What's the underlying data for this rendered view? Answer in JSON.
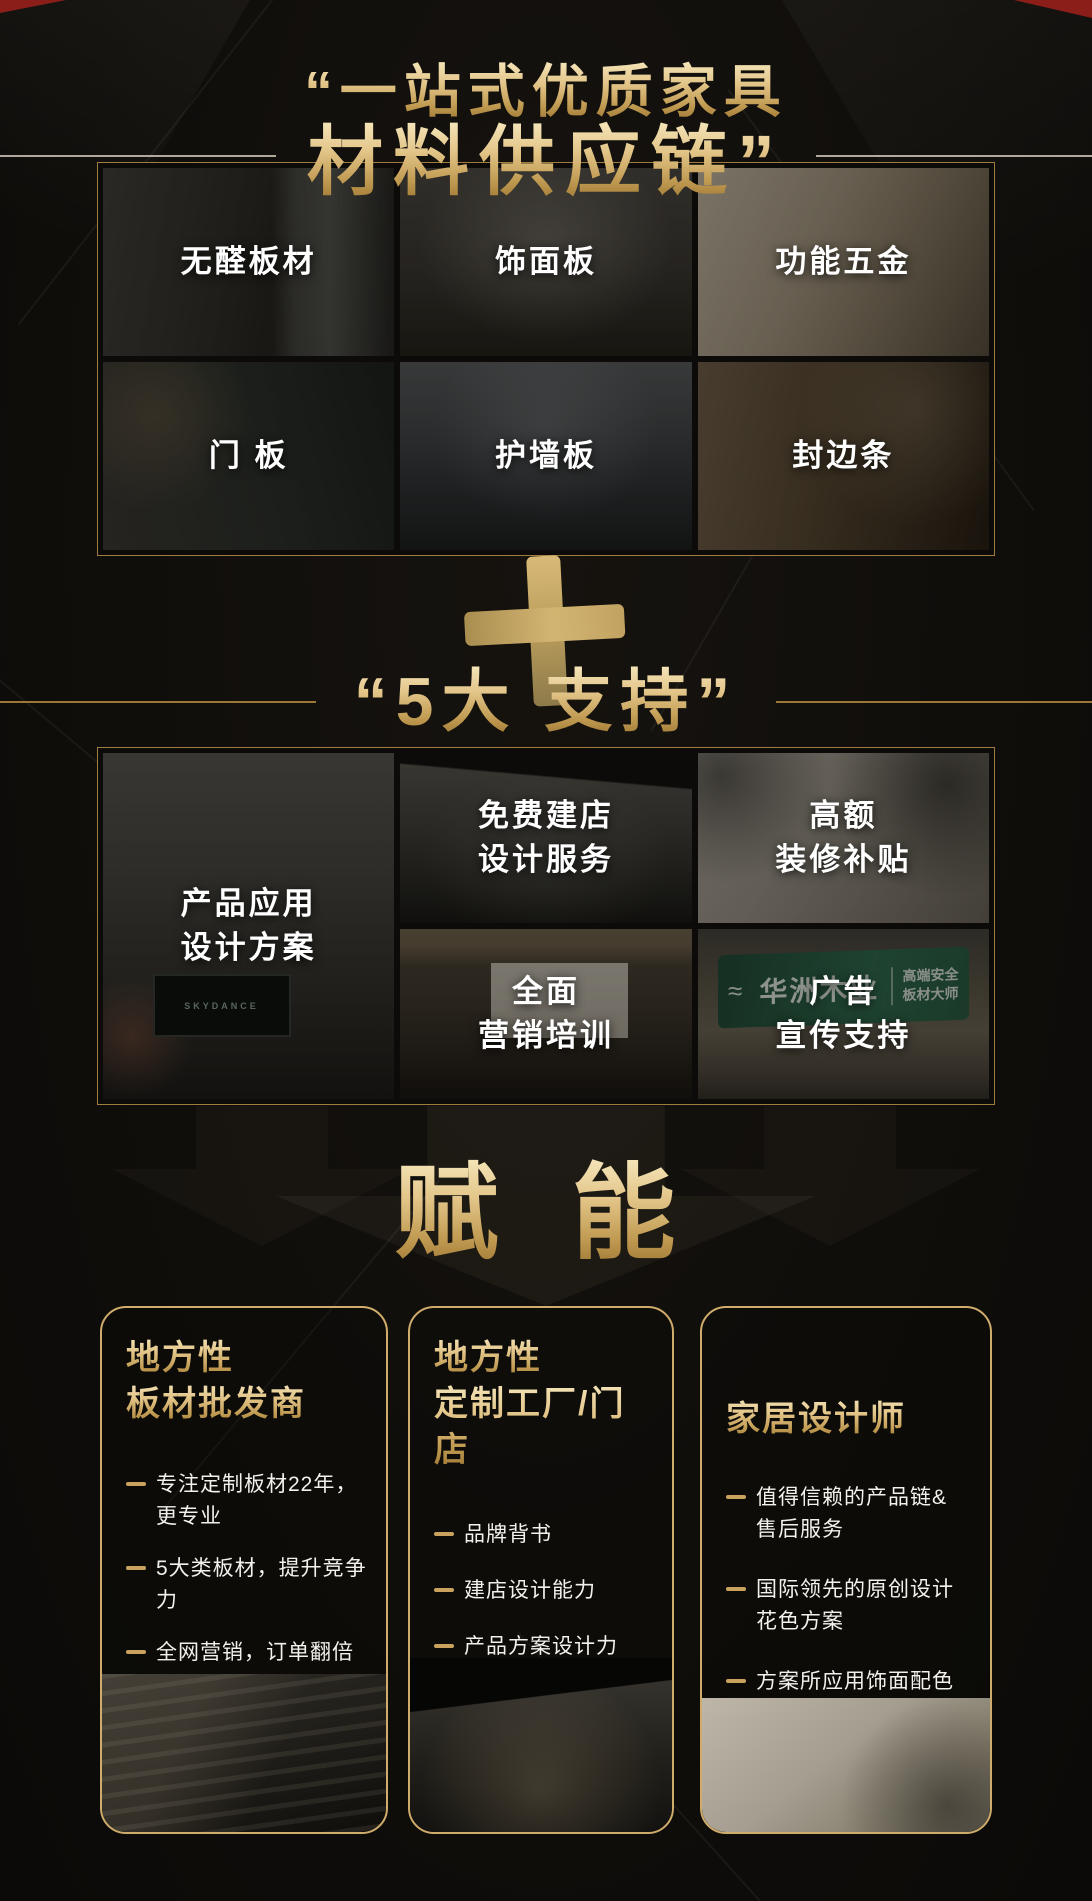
{
  "colors": {
    "gold": "#c9a35e",
    "gold_light": "#f6e7bc",
    "gold_dark": "#9a7430",
    "background": "#100e0b",
    "label_white": "#ffffff",
    "billboard_green": "#2f6b4e",
    "corner_red": "#8c1e1a"
  },
  "header": {
    "quote_open": "“",
    "line1": "一站式优质家具",
    "line2": "材料供应链",
    "quote_close": "”"
  },
  "materials": {
    "cells": [
      {
        "label": "无醛板材"
      },
      {
        "label": "饰面板"
      },
      {
        "label": "功能五金"
      },
      {
        "label": "门 板"
      },
      {
        "label": "护墙板"
      },
      {
        "label": "封边条"
      }
    ]
  },
  "plus_symbol": "+",
  "support": {
    "quote_open": "“",
    "title": "5大 支持",
    "quote_close": "”",
    "cells": {
      "design_plan": {
        "line1": "产品应用",
        "line2": "设计方案"
      },
      "store_design": {
        "line1": "免费建店",
        "line2": "设计服务"
      },
      "subsidy": {
        "line1": "高额",
        "line2": "装修补贴"
      },
      "marketing": {
        "line1": "全面",
        "line2": "营销培训"
      },
      "advertising": {
        "line1": "广告",
        "line2": "宣传支持"
      }
    },
    "billboard": {
      "brand": "华洲木业",
      "tag_line1": "高端安全",
      "tag_line2": "板材大师"
    },
    "tv_screen_text": "SKYDANCE"
  },
  "empower": {
    "title": "赋 能"
  },
  "cards": [
    {
      "title_line1": "地方性",
      "title_line2": "板材批发商",
      "bullets": [
        [
          "专注定制板材22年，",
          "更专业"
        ],
        [
          "5大类板材，提升竞争力"
        ],
        [
          "全网营销，订单翻倍"
        ],
        [
          "交付式产品设计，",
          "VR真实体验"
        ],
        [
          "8大政策支持"
        ]
      ]
    },
    {
      "title_line1": "地方性",
      "title_line2": "定制工厂/门店",
      "bullets": [
        [
          "品牌背书"
        ],
        [
          "建店设计能力"
        ],
        [
          "产品方案设计力"
        ],
        [
          "高端优质产品链供应"
        ]
      ]
    },
    {
      "title": "家居设计师",
      "bullets": [
        [
          "值得信赖的产品链&",
          "售后服务"
        ],
        [
          "国际领先的原创设计",
          "花色方案"
        ],
        [
          "方案所应用饰面配色",
          "高清还原"
        ]
      ]
    }
  ]
}
